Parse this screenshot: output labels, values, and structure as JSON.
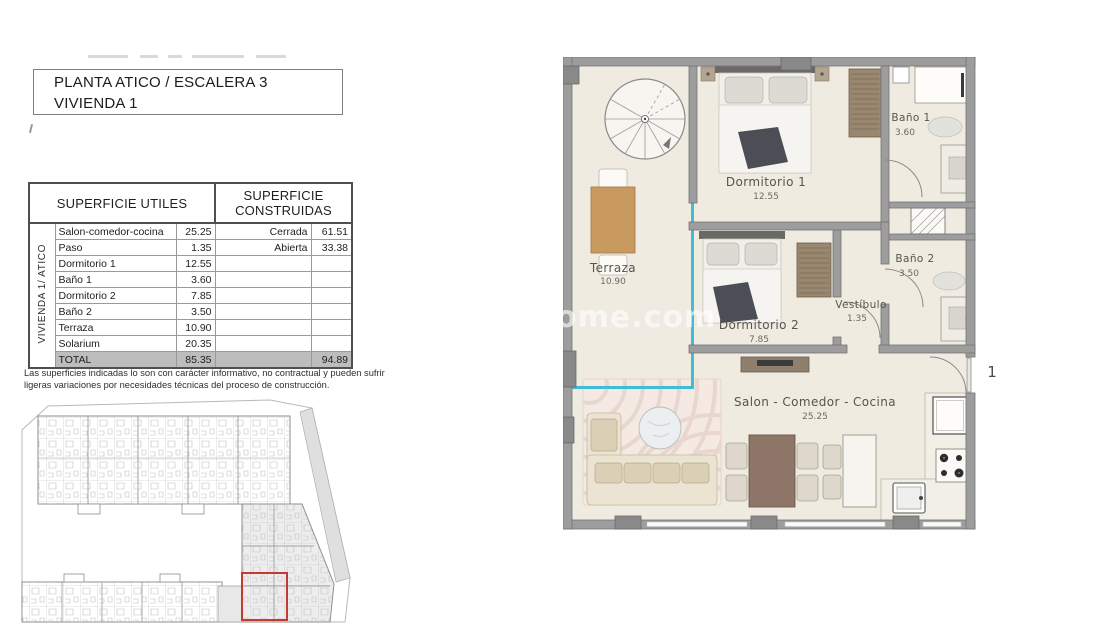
{
  "header": {
    "title_line1": "PLANTA ATICO / ESCALERA 3",
    "title_line2": "VIVIENDA 1"
  },
  "areas_table": {
    "useful_header": "SUPERFICIE UTILES",
    "built_header": "SUPERFICIE CONSTRUIDAS",
    "side_label": "VIVIENDA 1/ ATICO",
    "useful_rows": [
      {
        "label": "Salon-comedor-cocina",
        "m2": "25.25"
      },
      {
        "label": "Paso",
        "m2": "1.35"
      },
      {
        "label": "Dormitorio 1",
        "m2": "12.55"
      },
      {
        "label": "Baño 1",
        "m2": "3.60"
      },
      {
        "label": "Dormitorio 2",
        "m2": "7.85"
      },
      {
        "label": "Baño 2",
        "m2": "3.50"
      },
      {
        "label": "Terraza",
        "m2": "10.90"
      },
      {
        "label": "Solarium",
        "m2": "20.35"
      }
    ],
    "built_rows": [
      {
        "label": "Cerrada",
        "m2": "61.51"
      },
      {
        "label": "Abierta",
        "m2": "33.38"
      }
    ],
    "total": {
      "label": "TOTAL",
      "useful_m2": "85.35",
      "built_m2": "94.89"
    }
  },
  "disclaimer": {
    "line1": "Las superficies indicadas lo son con carácter informativo, no contractual y pueden sufrir",
    "line2": "ligeras variaciones por necesidades técnicas del proceso de construcción."
  },
  "floor_plan": {
    "rooms": [
      {
        "name": "Terraza",
        "area": "10.90"
      },
      {
        "name": "Dormitorio 1",
        "area": "12.55"
      },
      {
        "name": "Baño 1",
        "area": "3.60"
      },
      {
        "name": "Baño 2",
        "area": "3.50"
      },
      {
        "name": "Vestíbulo",
        "area": "1.35"
      },
      {
        "name": "Dormitorio 2",
        "area": "7.85"
      },
      {
        "name": "Salon - Comedor - Cocina",
        "area": "25.25"
      }
    ],
    "unit_number": "1",
    "watermark": "home.com"
  },
  "colors": {
    "glazing_accent": "#3FBDD6",
    "site_highlight": "#C03B33",
    "table_total_bg": "#BDBDBD"
  }
}
